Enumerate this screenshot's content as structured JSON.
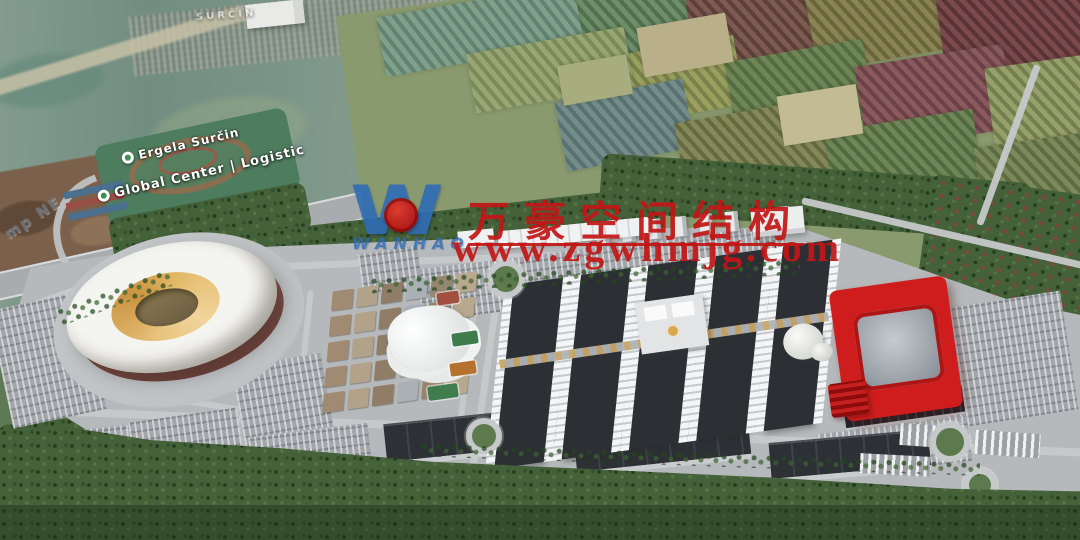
{
  "watermark": {
    "logo_letter": "W",
    "logo_subtext": "WANHAO",
    "company_cn": "万豪空间结构",
    "website": "www.zgwhmjg.com"
  },
  "map_labels": {
    "town": "SURČIN",
    "poi1": "Ergela Surčin",
    "poi2": "Global Center | Logistic",
    "ground_text": "mp NE"
  },
  "palette": {
    "wm_red": "#c21616",
    "logo_blue": "#2e6cb5",
    "arena_red": "#cf1d1d",
    "roof_gold": "#d9a84e",
    "plaza": "#b6b9bb",
    "road": "#c6c9ca",
    "parking": "#a2a6aa",
    "hall_dark": "#2c2f33",
    "forest_green": "#44613a"
  },
  "scene": {
    "farm_patches": [
      {
        "x": 560,
        "y": -10,
        "w": 150,
        "h": 70,
        "rot": -12,
        "sa": 60,
        "c1": "#6f8f6a",
        "c2": "#50704e"
      },
      {
        "x": 690,
        "y": -15,
        "w": 130,
        "h": 75,
        "rot": -10,
        "sa": 58,
        "c1": "#7d5a52",
        "c2": "#5d4038"
      },
      {
        "x": 810,
        "y": -20,
        "w": 140,
        "h": 80,
        "rot": -10,
        "sa": 58,
        "c1": "#8a8455",
        "c2": "#6b653c"
      },
      {
        "x": 940,
        "y": -20,
        "w": 150,
        "h": 90,
        "rot": -8,
        "sa": 55,
        "c1": "#7a4a4c",
        "c2": "#5a3336"
      },
      {
        "x": 620,
        "y": 45,
        "w": 120,
        "h": 70,
        "rot": -10,
        "sa": 60,
        "c1": "#9aa05e",
        "c2": "#7b814a"
      },
      {
        "x": 730,
        "y": 50,
        "w": 140,
        "h": 80,
        "rot": -10,
        "sa": 58,
        "c1": "#6f8757",
        "c2": "#556b42"
      },
      {
        "x": 860,
        "y": 55,
        "w": 150,
        "h": 85,
        "rot": -9,
        "sa": 56,
        "c1": "#8a5a5e",
        "c2": "#6b4247"
      },
      {
        "x": 990,
        "y": 60,
        "w": 120,
        "h": 90,
        "rot": -8,
        "sa": 55,
        "c1": "#97a06a",
        "c2": "#757e4f"
      },
      {
        "x": 560,
        "y": 90,
        "w": 130,
        "h": 70,
        "rot": -11,
        "sa": 60,
        "c1": "#748c8a",
        "c2": "#597170"
      },
      {
        "x": 680,
        "y": 110,
        "w": 150,
        "h": 80,
        "rot": -10,
        "sa": 58,
        "c1": "#85895a",
        "c2": "#666a41"
      },
      {
        "x": 830,
        "y": 120,
        "w": 150,
        "h": 90,
        "rot": -9,
        "sa": 56,
        "c1": "#6f8757",
        "c2": "#526a40"
      },
      {
        "x": 980,
        "y": 140,
        "w": 110,
        "h": 100,
        "rot": -8,
        "sa": 55,
        "c1": "#7a8a5a",
        "c2": "#5e6c42"
      },
      {
        "x": 1000,
        "y": 230,
        "w": 90,
        "h": 90,
        "rot": -8,
        "sa": 55,
        "c1": "#8a975f",
        "c2": "#6d7a46"
      },
      {
        "x": 380,
        "y": 0,
        "w": 200,
        "h": 60,
        "rot": -10,
        "sa": 62,
        "c1": "#7fa08a",
        "c2": "#638370"
      },
      {
        "x": 470,
        "y": 40,
        "w": 160,
        "h": 60,
        "rot": -10,
        "sa": 60,
        "c1": "#97a674",
        "c2": "#7a8a58"
      },
      {
        "x": 940,
        "y": 260,
        "w": 140,
        "h": 70,
        "rot": -8,
        "sa": 55,
        "c1": "#90845a",
        "c2": "#736844"
      },
      {
        "x": 640,
        "y": 20,
        "w": 90,
        "h": 50,
        "rot": -10,
        "sa": 0,
        "c1": "#b9b08a",
        "c2": "#b9b08a"
      },
      {
        "x": 780,
        "y": 90,
        "w": 80,
        "h": 50,
        "rot": -9,
        "sa": 0,
        "c1": "#c2bb93",
        "c2": "#c2bb93"
      },
      {
        "x": 560,
        "y": 60,
        "w": 70,
        "h": 40,
        "rot": -10,
        "sa": 0,
        "c1": "#a8ad7f",
        "c2": "#a8ad7f"
      }
    ],
    "forests": [
      {
        "x": 110,
        "y": 200,
        "w": 200,
        "h": 48,
        "rot": -11,
        "red": false
      },
      {
        "x": 195,
        "y": 212,
        "w": 470,
        "h": 60,
        "rot": -6.5,
        "red": false
      },
      {
        "x": 600,
        "y": 168,
        "w": 430,
        "h": 58,
        "rot": 4,
        "red": false
      },
      {
        "x": 920,
        "y": 185,
        "w": 175,
        "h": 165,
        "rot": 8,
        "red": true
      },
      {
        "x": 0,
        "y": 418,
        "w": 140,
        "h": 60,
        "rot": -6,
        "red": false
      }
    ],
    "roads": [
      {
        "x": 90,
        "y": 256,
        "w": 730,
        "h": 7,
        "rot": -2.3
      },
      {
        "x": 798,
        "y": 232,
        "w": 310,
        "h": 7,
        "rot": 13
      },
      {
        "x": 55,
        "y": 428,
        "w": 1035,
        "h": 8,
        "rot": 2.3
      },
      {
        "x": 484,
        "y": 262,
        "w": 7,
        "h": 205,
        "rot": 8
      },
      {
        "x": 928,
        "y": 300,
        "w": 7,
        "h": 135,
        "rot": 10
      },
      {
        "x": 300,
        "y": 290,
        "w": 6,
        "h": 150,
        "rot": 6
      },
      {
        "x": 465,
        "y": 288,
        "w": 6,
        "h": 145,
        "rot": 7
      },
      {
        "x": 60,
        "y": 398,
        "w": 250,
        "h": 6,
        "rot": 9
      },
      {
        "x": 0,
        "y": 292,
        "w": 120,
        "h": 9,
        "rot": -20
      },
      {
        "x": 1005,
        "y": 60,
        "w": 7,
        "h": 170,
        "rot": 20
      }
    ],
    "parkings": [
      {
        "x": 418,
        "y": 247,
        "w": 370,
        "h": 52,
        "rot": -7
      },
      {
        "x": 0,
        "y": 300,
        "w": 95,
        "h": 120,
        "rot": -12
      },
      {
        "x": 238,
        "y": 360,
        "w": 90,
        "h": 80,
        "rot": -10
      },
      {
        "x": 250,
        "y": 430,
        "w": 120,
        "h": 40,
        "rot": -7
      },
      {
        "x": 940,
        "y": 300,
        "w": 130,
        "h": 120,
        "rot": -9
      },
      {
        "x": 820,
        "y": 425,
        "w": 150,
        "h": 45,
        "rot": -7
      },
      {
        "x": 20,
        "y": 430,
        "w": 120,
        "h": 40,
        "rot": -6
      },
      {
        "x": 360,
        "y": 250,
        "w": 60,
        "h": 40,
        "rot": -8
      },
      {
        "x": 130,
        "y": 415,
        "w": 110,
        "h": 38,
        "rot": -8
      }
    ],
    "solar_lots": [
      {
        "x": 756,
        "y": 286,
        "w": 80,
        "h": 24,
        "rot": -8
      },
      {
        "x": 842,
        "y": 288,
        "w": 75,
        "h": 22,
        "rot": -8
      },
      {
        "x": 844,
        "y": 394,
        "w": 120,
        "h": 26,
        "rot": -8
      }
    ],
    "warehouses": [
      {
        "x": 385,
        "y": 415,
        "w": 175,
        "h": 36,
        "rot": -6
      },
      {
        "x": 575,
        "y": 425,
        "w": 175,
        "h": 36,
        "rot": -6
      },
      {
        "x": 770,
        "y": 436,
        "w": 160,
        "h": 34,
        "rot": -5
      }
    ],
    "bus_lots": [
      {
        "x": 900,
        "y": 425,
        "w": 60,
        "h": 22,
        "rot": 4
      },
      {
        "x": 975,
        "y": 432,
        "w": 65,
        "h": 24,
        "rot": 4
      },
      {
        "x": 860,
        "y": 455,
        "w": 70,
        "h": 20,
        "rot": 3
      }
    ],
    "roundabouts": [
      {
        "x": 487,
        "y": 260,
        "r": 13
      },
      {
        "x": 466,
        "y": 418,
        "r": 12
      },
      {
        "x": 930,
        "y": 422,
        "r": 14
      },
      {
        "x": 963,
        "y": 468,
        "r": 11
      },
      {
        "x": 104,
        "y": 444,
        "r": 11
      }
    ],
    "tree_strips": [
      {
        "x": 370,
        "y": 268,
        "w": 430,
        "h": 16,
        "rot": -2.5
      },
      {
        "x": 55,
        "y": 288,
        "w": 120,
        "h": 18,
        "rot": -20
      },
      {
        "x": 420,
        "y": 452,
        "w": 560,
        "h": 14,
        "rot": 2
      }
    ],
    "courts": [
      {
        "x": 437,
        "y": 292,
        "w": 22,
        "h": 12,
        "rot": -8,
        "c": "#a34f3f"
      },
      {
        "x": 452,
        "y": 332,
        "w": 26,
        "h": 13,
        "rot": -8,
        "c": "#3f7d4f"
      },
      {
        "x": 450,
        "y": 362,
        "w": 26,
        "h": 13,
        "rot": -8,
        "c": "#b5722f"
      },
      {
        "x": 428,
        "y": 385,
        "w": 30,
        "h": 14,
        "rot": -8,
        "c": "#3f7d4f"
      }
    ],
    "village": {
      "cols": 6,
      "rows": 5,
      "cw": 21,
      "ch": 19,
      "gx": 4,
      "gy": 6,
      "colors": [
        "#a08b72",
        "#b3a28a",
        "#8f7d68",
        "#a9b0b6",
        "#96866f",
        "#b8a98e"
      ]
    },
    "halls": {
      "count": 5,
      "w": 50,
      "gap": 18
    },
    "offices": {
      "count": 8,
      "w": 13,
      "gap": 13
    }
  }
}
